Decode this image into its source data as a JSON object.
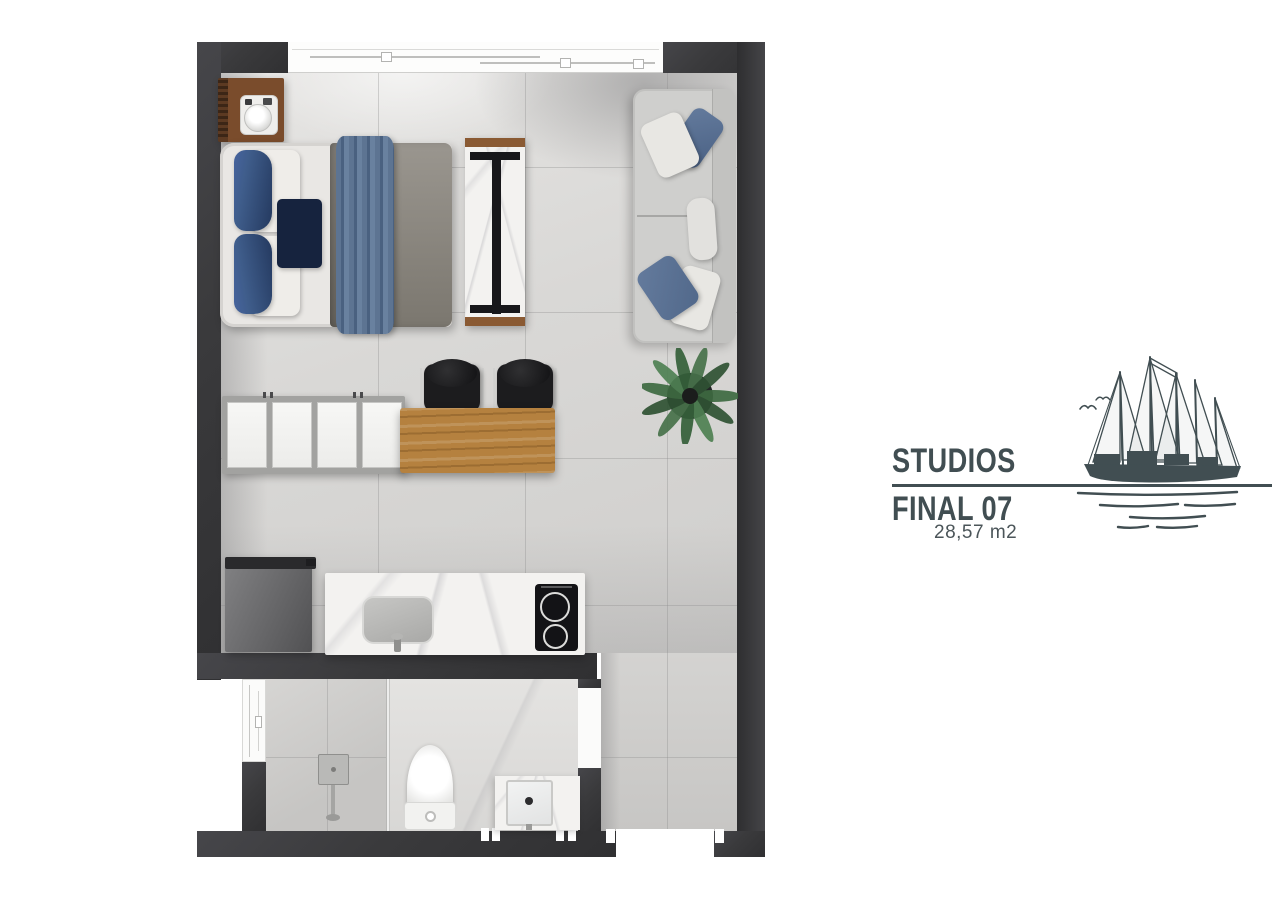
{
  "brand": {
    "line1": "STUDIOS",
    "line2": "FINAL 07",
    "area": "28,57 m2",
    "illustration": "sailboat-sketch"
  },
  "palette": {
    "ink": "#414e52",
    "wall": "#3a3a3c",
    "floor_light": "#e4e3e1",
    "floor_dark": "#cfcecc",
    "wood_dark": "#7a4c2c",
    "wood_table": "#b5813f",
    "marble": "#f3f2f0",
    "sofa_gray": "#cfcfcd",
    "duvet_gray": "#8e8a84",
    "pillow_blue": "#3f5d8b",
    "pillow_navy": "#16233e",
    "throw_blue": "#5d7492",
    "plant_green": "#3e6a41",
    "appliance_black": "#141416"
  },
  "plan": {
    "rooms": [
      {
        "name": "studio-main"
      },
      {
        "name": "bathroom"
      },
      {
        "name": "entry-hall"
      }
    ],
    "furniture": [
      "nightstand",
      "double-bed",
      "tv-panel",
      "sofa",
      "potted-plant",
      "wardrobe",
      "dining-table",
      "dining-chair",
      "dining-chair",
      "refrigerator",
      "kitchen-counter",
      "kitchen-sink",
      "cooktop",
      "shower-column",
      "toilet",
      "vanity-sink"
    ],
    "openings": [
      "main-window",
      "bathroom-window",
      "bathroom-door",
      "entry-door"
    ]
  }
}
